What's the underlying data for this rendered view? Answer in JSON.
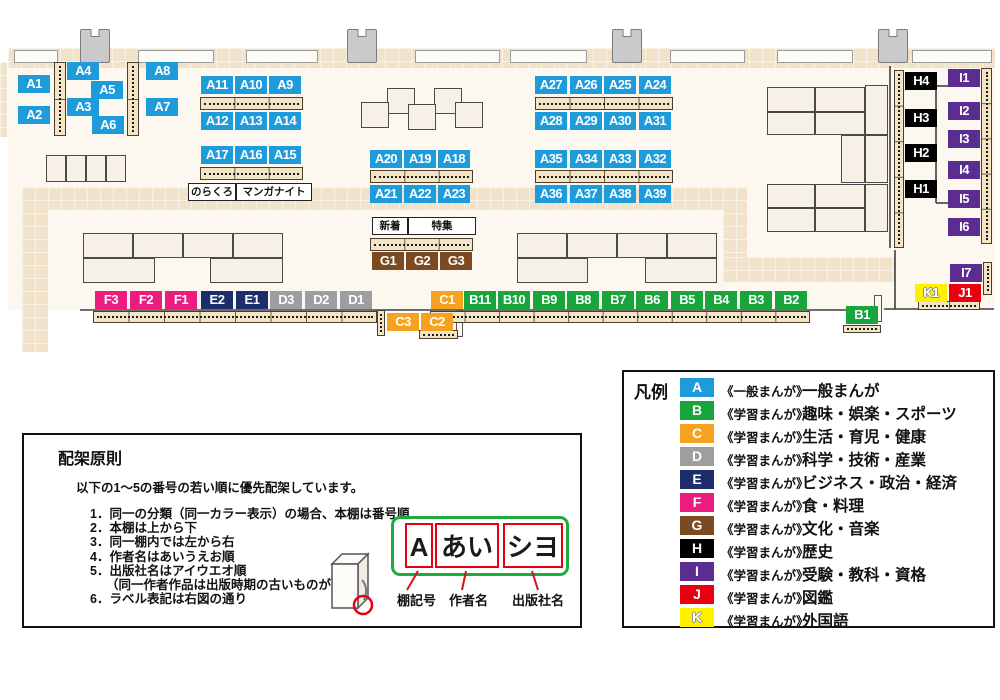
{
  "categories": {
    "A": {
      "color": "#1d9bdb"
    },
    "B": {
      "color": "#18a53c"
    },
    "C": {
      "color": "#f6a11f"
    },
    "D": {
      "color": "#9d9ea0"
    },
    "E": {
      "color": "#1b2d6b"
    },
    "F": {
      "color": "#ed1c7f"
    },
    "G": {
      "color": "#7b4a20"
    },
    "H": {
      "color": "#000000"
    },
    "I": {
      "color": "#5c2d90"
    },
    "J": {
      "color": "#e8000f"
    },
    "K": {
      "color": "#fff000",
      "outlined": true
    }
  },
  "map": {
    "labels": [
      {
        "id": "A1",
        "cat": "A",
        "x": 18,
        "y": 75
      },
      {
        "id": "A2",
        "cat": "A",
        "x": 18,
        "y": 106
      },
      {
        "id": "A4",
        "cat": "A",
        "x": 67,
        "y": 62
      },
      {
        "id": "A3",
        "cat": "A",
        "x": 67,
        "y": 98
      },
      {
        "id": "A5",
        "cat": "A",
        "x": 91,
        "y": 81
      },
      {
        "id": "A6",
        "cat": "A",
        "x": 92,
        "y": 116
      },
      {
        "id": "A8",
        "cat": "A",
        "x": 146,
        "y": 62
      },
      {
        "id": "A7",
        "cat": "A",
        "x": 146,
        "y": 98
      },
      {
        "id": "A11",
        "cat": "A",
        "x": 201,
        "y": 76
      },
      {
        "id": "A10",
        "cat": "A",
        "x": 235,
        "y": 76
      },
      {
        "id": "A9",
        "cat": "A",
        "x": 269,
        "y": 76
      },
      {
        "id": "A12",
        "cat": "A",
        "x": 201,
        "y": 112
      },
      {
        "id": "A13",
        "cat": "A",
        "x": 235,
        "y": 112
      },
      {
        "id": "A14",
        "cat": "A",
        "x": 269,
        "y": 112
      },
      {
        "id": "A17",
        "cat": "A",
        "x": 201,
        "y": 146
      },
      {
        "id": "A16",
        "cat": "A",
        "x": 235,
        "y": 146
      },
      {
        "id": "A15",
        "cat": "A",
        "x": 269,
        "y": 146
      },
      {
        "id": "A20",
        "cat": "A",
        "x": 370,
        "y": 150
      },
      {
        "id": "A19",
        "cat": "A",
        "x": 404,
        "y": 150
      },
      {
        "id": "A18",
        "cat": "A",
        "x": 438,
        "y": 150
      },
      {
        "id": "A21",
        "cat": "A",
        "x": 370,
        "y": 185
      },
      {
        "id": "A22",
        "cat": "A",
        "x": 404,
        "y": 185
      },
      {
        "id": "A23",
        "cat": "A",
        "x": 438,
        "y": 185
      },
      {
        "id": "A27",
        "cat": "A",
        "x": 535,
        "y": 76
      },
      {
        "id": "A26",
        "cat": "A",
        "x": 570,
        "y": 76
      },
      {
        "id": "A25",
        "cat": "A",
        "x": 604,
        "y": 76
      },
      {
        "id": "A24",
        "cat": "A",
        "x": 639,
        "y": 76
      },
      {
        "id": "A28",
        "cat": "A",
        "x": 535,
        "y": 112
      },
      {
        "id": "A29",
        "cat": "A",
        "x": 570,
        "y": 112
      },
      {
        "id": "A30",
        "cat": "A",
        "x": 604,
        "y": 112
      },
      {
        "id": "A31",
        "cat": "A",
        "x": 639,
        "y": 112
      },
      {
        "id": "A35",
        "cat": "A",
        "x": 535,
        "y": 150
      },
      {
        "id": "A34",
        "cat": "A",
        "x": 570,
        "y": 150
      },
      {
        "id": "A33",
        "cat": "A",
        "x": 604,
        "y": 150
      },
      {
        "id": "A32",
        "cat": "A",
        "x": 639,
        "y": 150
      },
      {
        "id": "A36",
        "cat": "A",
        "x": 535,
        "y": 185
      },
      {
        "id": "A37",
        "cat": "A",
        "x": 570,
        "y": 185
      },
      {
        "id": "A38",
        "cat": "A",
        "x": 604,
        "y": 185
      },
      {
        "id": "A39",
        "cat": "A",
        "x": 639,
        "y": 185
      },
      {
        "id": "G1",
        "cat": "G",
        "x": 372,
        "y": 252
      },
      {
        "id": "G2",
        "cat": "G",
        "x": 406,
        "y": 252
      },
      {
        "id": "G3",
        "cat": "G",
        "x": 440,
        "y": 252
      },
      {
        "id": "F3",
        "cat": "F",
        "x": 95,
        "y": 291
      },
      {
        "id": "F2",
        "cat": "F",
        "x": 130,
        "y": 291
      },
      {
        "id": "F1",
        "cat": "F",
        "x": 165,
        "y": 291
      },
      {
        "id": "E2",
        "cat": "E",
        "x": 201,
        "y": 291
      },
      {
        "id": "E1",
        "cat": "E",
        "x": 236,
        "y": 291
      },
      {
        "id": "D3",
        "cat": "D",
        "x": 270,
        "y": 291
      },
      {
        "id": "D2",
        "cat": "D",
        "x": 305,
        "y": 291
      },
      {
        "id": "D1",
        "cat": "D",
        "x": 340,
        "y": 291
      },
      {
        "id": "C1",
        "cat": "C",
        "x": 431,
        "y": 291
      },
      {
        "id": "C3",
        "cat": "C",
        "x": 387,
        "y": 313
      },
      {
        "id": "C2",
        "cat": "C",
        "x": 421,
        "y": 313
      },
      {
        "id": "B11",
        "cat": "B",
        "x": 464,
        "y": 291
      },
      {
        "id": "B10",
        "cat": "B",
        "x": 498,
        "y": 291
      },
      {
        "id": "B9",
        "cat": "B",
        "x": 533,
        "y": 291
      },
      {
        "id": "B8",
        "cat": "B",
        "x": 567,
        "y": 291
      },
      {
        "id": "B7",
        "cat": "B",
        "x": 602,
        "y": 291
      },
      {
        "id": "B6",
        "cat": "B",
        "x": 636,
        "y": 291
      },
      {
        "id": "B5",
        "cat": "B",
        "x": 671,
        "y": 291
      },
      {
        "id": "B4",
        "cat": "B",
        "x": 705,
        "y": 291
      },
      {
        "id": "B3",
        "cat": "B",
        "x": 740,
        "y": 291
      },
      {
        "id": "B2",
        "cat": "B",
        "x": 775,
        "y": 291
      },
      {
        "id": "B1",
        "cat": "B",
        "x": 846,
        "y": 306
      },
      {
        "id": "H4",
        "cat": "H",
        "x": 905,
        "y": 72
      },
      {
        "id": "H3",
        "cat": "H",
        "x": 905,
        "y": 109
      },
      {
        "id": "H2",
        "cat": "H",
        "x": 905,
        "y": 144
      },
      {
        "id": "H1",
        "cat": "H",
        "x": 905,
        "y": 180
      },
      {
        "id": "I1",
        "cat": "I",
        "x": 948,
        "y": 69
      },
      {
        "id": "I2",
        "cat": "I",
        "x": 948,
        "y": 102
      },
      {
        "id": "I3",
        "cat": "I",
        "x": 948,
        "y": 130
      },
      {
        "id": "I4",
        "cat": "I",
        "x": 948,
        "y": 161
      },
      {
        "id": "I5",
        "cat": "I",
        "x": 948,
        "y": 190
      },
      {
        "id": "I6",
        "cat": "I",
        "x": 948,
        "y": 218
      },
      {
        "id": "I7",
        "cat": "I",
        "x": 950,
        "y": 264
      },
      {
        "id": "K1",
        "cat": "K",
        "x": 915,
        "y": 284
      },
      {
        "id": "J1",
        "cat": "J",
        "x": 949,
        "y": 284
      }
    ],
    "tags": [
      {
        "text": "のらくろ",
        "x": 188,
        "y": 183,
        "w": 46
      },
      {
        "text": "マンガナイト",
        "x": 236,
        "y": 183,
        "w": 74
      },
      {
        "text": "新着",
        "x": 372,
        "y": 217,
        "w": 34
      },
      {
        "text": "特集",
        "x": 408,
        "y": 217,
        "w": 66
      }
    ],
    "hstrips": [
      {
        "x": 200,
        "y": 97,
        "w": 103,
        "h": 13,
        "seg": 3
      },
      {
        "x": 200,
        "y": 167,
        "w": 103,
        "h": 13,
        "seg": 3
      },
      {
        "x": 370,
        "y": 170,
        "w": 103,
        "h": 13,
        "seg": 3
      },
      {
        "x": 535,
        "y": 97,
        "w": 138,
        "h": 13,
        "seg": 4
      },
      {
        "x": 535,
        "y": 170,
        "w": 138,
        "h": 13,
        "seg": 4
      },
      {
        "x": 370,
        "y": 238,
        "w": 103,
        "h": 13,
        "seg": 3
      },
      {
        "x": 93,
        "y": 311,
        "w": 284,
        "h": 12,
        "seg": 8
      },
      {
        "x": 430,
        "y": 311,
        "w": 380,
        "h": 12,
        "seg": 11
      },
      {
        "x": 419,
        "y": 330,
        "w": 39,
        "h": 9,
        "seg": 1
      },
      {
        "x": 843,
        "y": 325,
        "w": 38,
        "h": 8,
        "seg": 1
      },
      {
        "x": 918,
        "y": 301,
        "w": 62,
        "h": 9,
        "seg": 2
      }
    ],
    "vstrips": [
      {
        "x": 54,
        "y": 62,
        "w": 12,
        "h": 74,
        "seg": 2
      },
      {
        "x": 127,
        "y": 62,
        "w": 12,
        "h": 74,
        "seg": 2
      },
      {
        "x": 894,
        "y": 70,
        "w": 10,
        "h": 178,
        "seg": 5
      },
      {
        "x": 981,
        "y": 68,
        "w": 11,
        "h": 176,
        "seg": 5
      },
      {
        "x": 983,
        "y": 262,
        "w": 9,
        "h": 33,
        "seg": 1
      },
      {
        "x": 377,
        "y": 310,
        "w": 8,
        "h": 26,
        "seg": 1
      }
    ],
    "tables": [
      [
        46,
        155,
        20,
        27
      ],
      [
        66,
        155,
        20,
        27
      ],
      [
        86,
        155,
        20,
        27
      ],
      [
        106,
        155,
        20,
        27
      ],
      [
        83,
        233,
        50,
        25
      ],
      [
        133,
        233,
        50,
        25
      ],
      [
        183,
        233,
        50,
        25
      ],
      [
        233,
        233,
        50,
        25
      ],
      [
        83,
        258,
        72,
        25
      ],
      [
        210,
        258,
        73,
        25
      ],
      [
        517,
        233,
        50,
        25
      ],
      [
        567,
        233,
        50,
        25
      ],
      [
        617,
        233,
        50,
        25
      ],
      [
        667,
        233,
        50,
        25
      ],
      [
        517,
        258,
        71,
        25
      ],
      [
        645,
        258,
        72,
        25
      ],
      [
        387,
        88,
        28,
        26
      ],
      [
        434,
        88,
        28,
        26
      ],
      [
        361,
        102,
        28,
        26
      ],
      [
        408,
        104,
        28,
        26
      ],
      [
        455,
        102,
        28,
        26
      ]
    ],
    "blocks": [
      [
        767,
        87,
        48,
        25
      ],
      [
        815,
        87,
        50,
        25
      ],
      [
        767,
        112,
        48,
        23
      ],
      [
        815,
        112,
        50,
        23
      ],
      [
        865,
        85,
        23,
        50
      ],
      [
        841,
        135,
        24,
        48
      ],
      [
        865,
        135,
        23,
        48
      ],
      [
        767,
        184,
        48,
        24
      ],
      [
        815,
        184,
        50,
        24
      ],
      [
        767,
        208,
        48,
        24
      ],
      [
        815,
        208,
        50,
        24
      ],
      [
        865,
        184,
        23,
        48
      ]
    ],
    "carpets": [
      [
        8,
        48,
        987,
        20
      ],
      [
        22,
        187,
        720,
        23
      ],
      [
        22,
        187,
        26,
        165
      ],
      [
        723,
        187,
        24,
        80
      ],
      [
        723,
        257,
        172,
        25
      ],
      [
        0,
        62,
        7,
        75
      ]
    ],
    "windows": [
      [
        14,
        50,
        44,
        13
      ],
      [
        138,
        50,
        76,
        13
      ],
      [
        246,
        50,
        72,
        13
      ],
      [
        415,
        50,
        85,
        13
      ],
      [
        510,
        50,
        77,
        13
      ],
      [
        670,
        50,
        75,
        13
      ],
      [
        777,
        50,
        76,
        13
      ],
      [
        912,
        50,
        80,
        13
      ]
    ],
    "pillars": [
      [
        80,
        29
      ],
      [
        347,
        29
      ],
      [
        612,
        29
      ],
      [
        878,
        29
      ]
    ],
    "wall_pieces": [
      [
        874,
        295,
        8,
        27
      ],
      [
        456,
        310,
        7,
        27
      ]
    ],
    "walls": [
      "M80 310 H876",
      "M884 309 H994",
      "M895 250 V309",
      "M890 66 V248",
      "M936 86 V203",
      "M936 86 H949",
      "M936 203 H949"
    ]
  },
  "legend": {
    "title": "凡例",
    "rows": [
      {
        "code": "A",
        "type": "《一般まんが》",
        "category": "一般まんが"
      },
      {
        "code": "B",
        "type": "《学習まんが》",
        "category": "趣味・娯楽・スポーツ"
      },
      {
        "code": "C",
        "type": "《学習まんが》",
        "category": "生活・育児・健康"
      },
      {
        "code": "D",
        "type": "《学習まんが》",
        "category": "科学・技術・産業"
      },
      {
        "code": "E",
        "type": "《学習まんが》",
        "category": "ビジネス・政治・経済"
      },
      {
        "code": "F",
        "type": "《学習まんが》",
        "category": "食・料理"
      },
      {
        "code": "G",
        "type": "《学習まんが》",
        "category": "文化・音楽"
      },
      {
        "code": "H",
        "type": "《学習まんが》",
        "category": "歴史"
      },
      {
        "code": "I",
        "type": "《学習まんが》",
        "category": "受験・教科・資格"
      },
      {
        "code": "J",
        "type": "《学習まんが》",
        "category": "図鑑"
      },
      {
        "code": "K",
        "type": "《学習まんが》",
        "category": "外国語"
      }
    ]
  },
  "principles": {
    "title": "配架原則",
    "intro": "以下の1～5の番号の若い順に優先配架しています。",
    "items": [
      "1．同一の分類（同一カラー表示）の場合、本棚は番号順",
      "2．本棚は上から下",
      "3．同一棚内では左から右",
      "4．作者名はあいうえお順",
      "5．出版社名はアイウエオ順",
      "（同一作者作品は出版時期の古いものが先）",
      "6．ラベル表記は右図の通り"
    ],
    "diagram": {
      "shelf_code": "A",
      "author": "あい",
      "publisher": "シヨ",
      "pointer_labels": [
        "棚記号",
        "作者名",
        "出版社名"
      ]
    }
  }
}
